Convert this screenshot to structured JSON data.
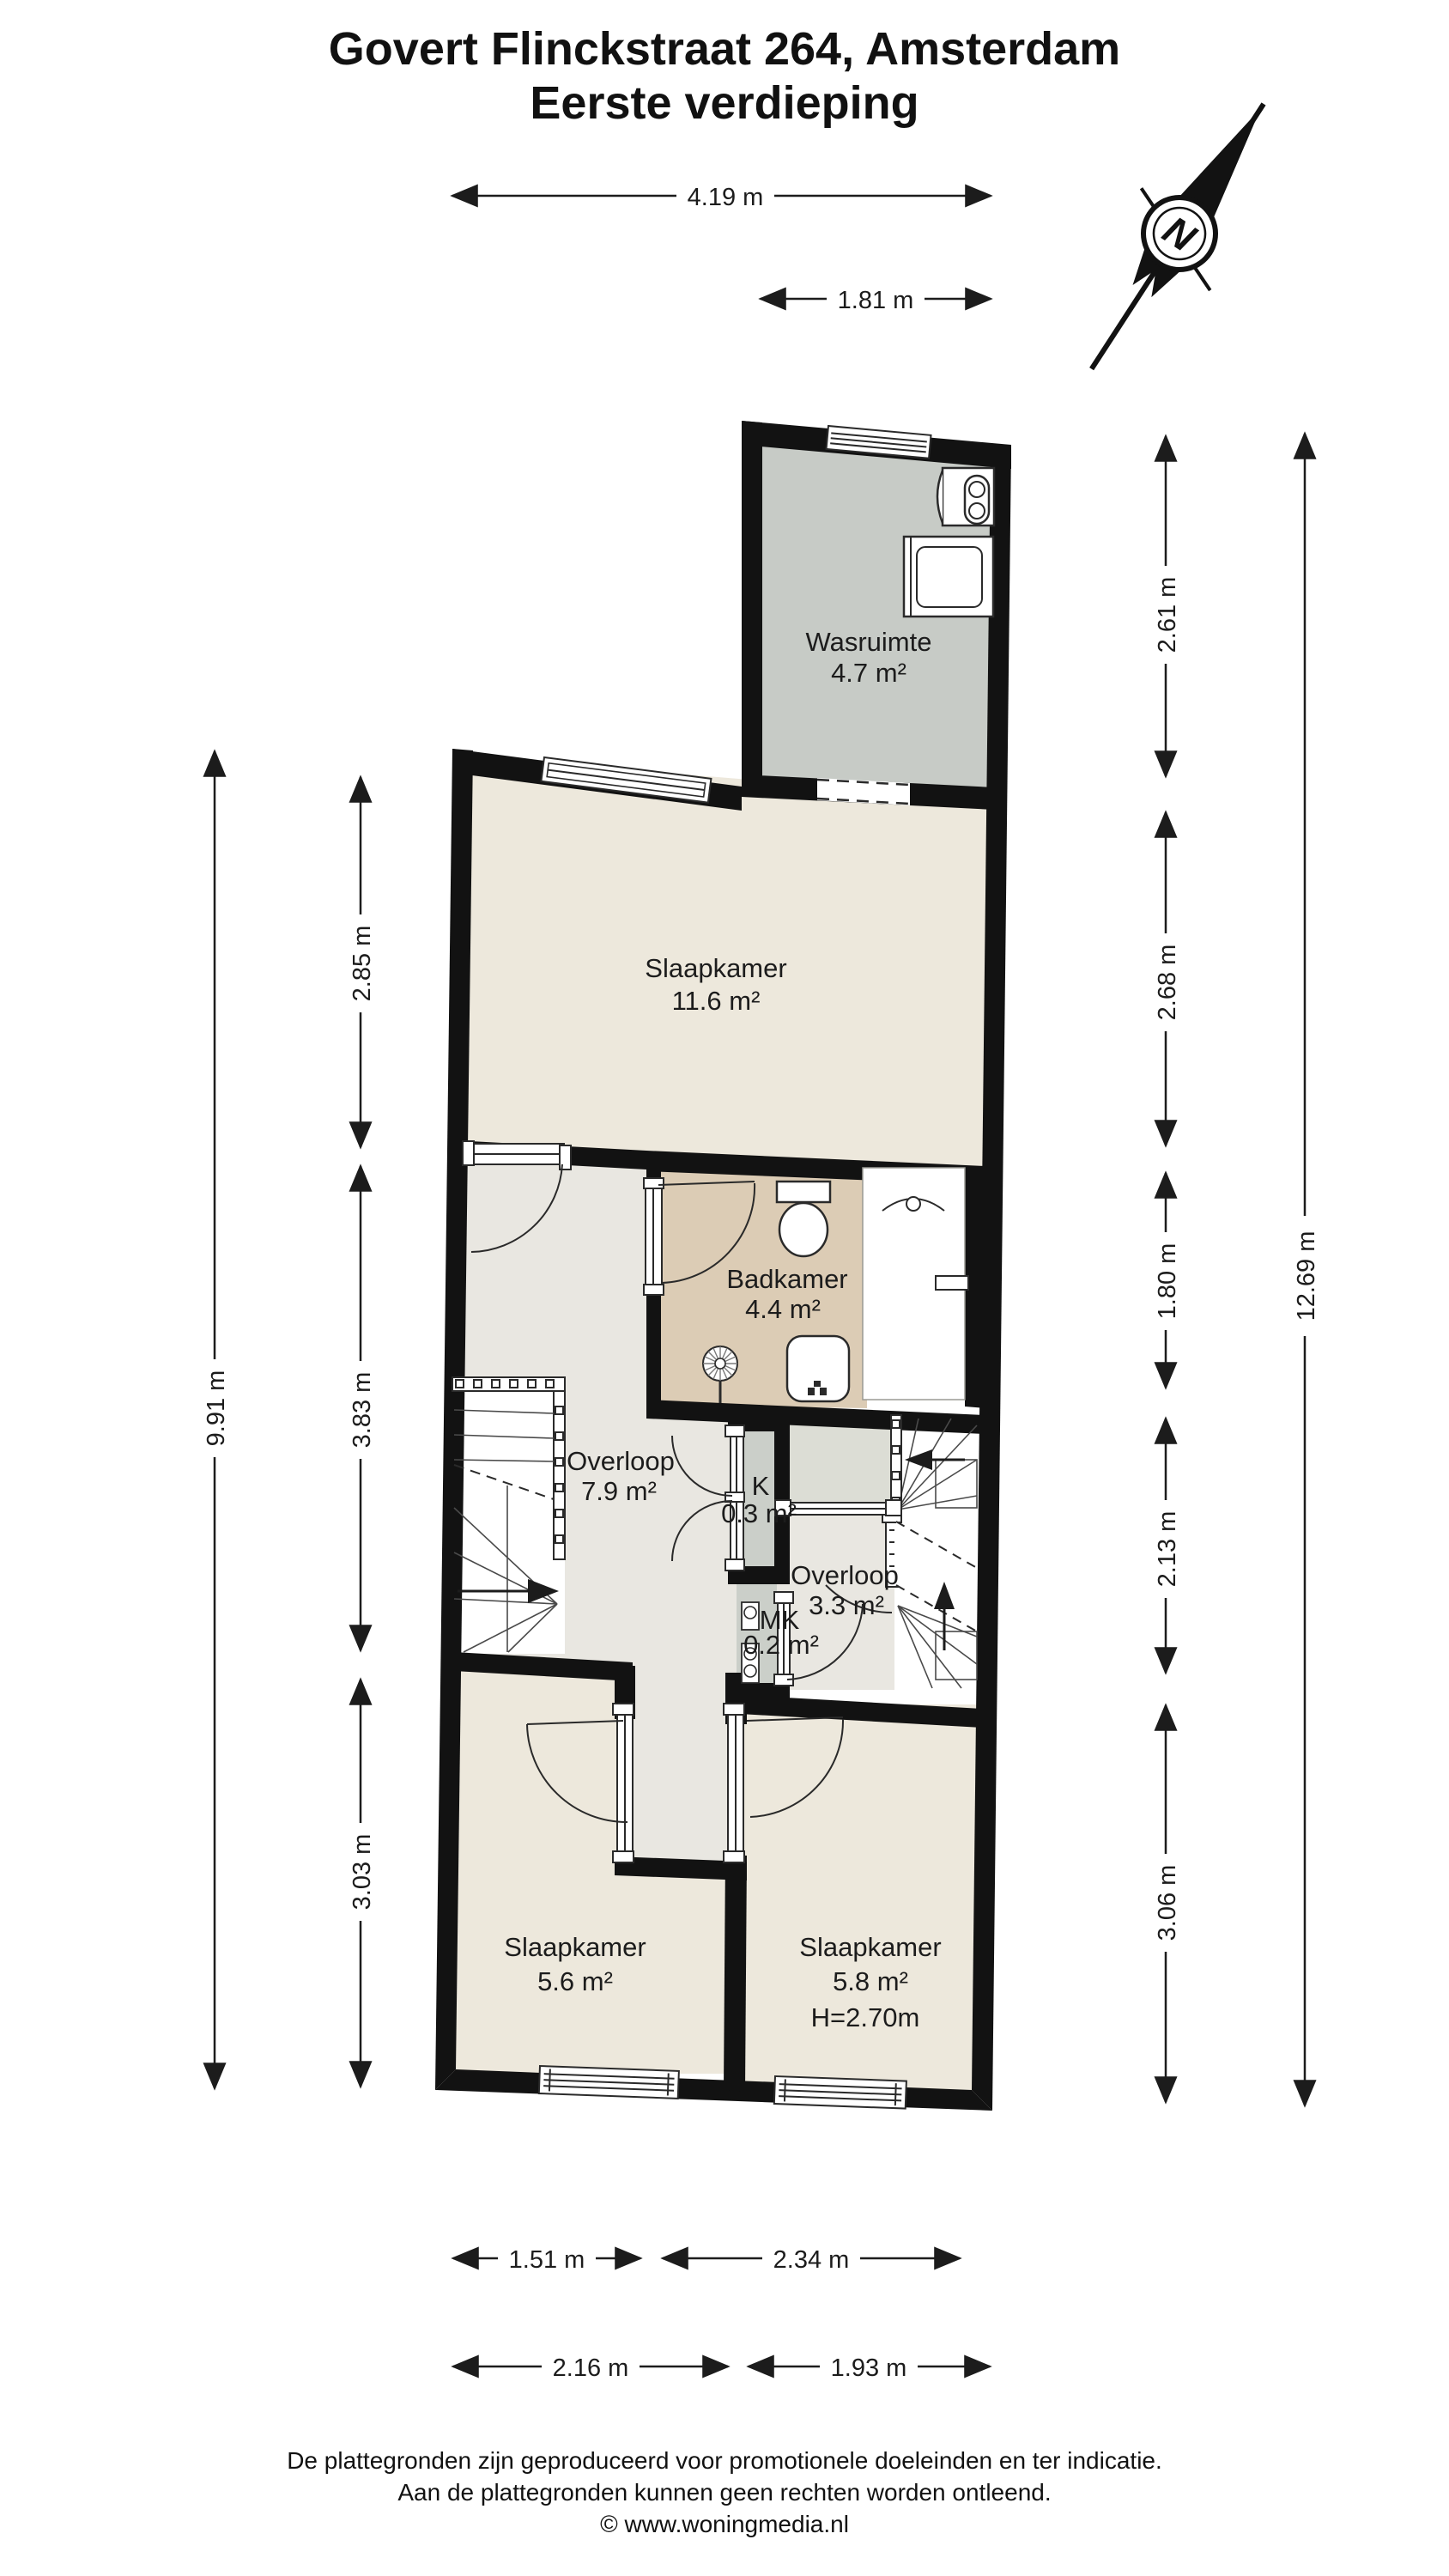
{
  "title": {
    "line1": "Govert Flinckstraat 264, Amsterdam",
    "line2": "Eerste verdieping"
  },
  "compass": {
    "label": "N"
  },
  "rooms": {
    "wasruimte": {
      "name": "Wasruimte",
      "area": "4.7 m²"
    },
    "slaapkamer_boven": {
      "name": "Slaapkamer",
      "area": "11.6 m²"
    },
    "badkamer": {
      "name": "Badkamer",
      "area": "4.4 m²"
    },
    "overloop": {
      "name": "Overloop",
      "area": "7.9 m²"
    },
    "kast": {
      "name": "K",
      "area": "0.3 m²"
    },
    "overloop2": {
      "name": "Overloop",
      "area": "3.3 m²"
    },
    "meterkast": {
      "name": "MK",
      "area": "0.2 m²"
    },
    "slaapkamer_links": {
      "name": "Slaapkamer",
      "area": "5.6 m²"
    },
    "slaapkamer_rechts": {
      "name": "Slaapkamer",
      "area": "5.8 m²",
      "height": "H=2.70m"
    }
  },
  "dimensions": {
    "top": [
      {
        "label": "4.19 m"
      },
      {
        "label": "1.81 m"
      }
    ],
    "left": [
      {
        "label": "2.85 m"
      },
      {
        "label": "3.83 m"
      },
      {
        "label": "3.03 m"
      },
      {
        "label": "9.91 m"
      }
    ],
    "right": [
      {
        "label": "2.61 m"
      },
      {
        "label": "2.68 m"
      },
      {
        "label": "1.80 m"
      },
      {
        "label": "2.13 m"
      },
      {
        "label": "3.06 m"
      },
      {
        "label": "12.69 m"
      }
    ],
    "bottom": [
      {
        "label": "1.51 m"
      },
      {
        "label": "2.34 m"
      },
      {
        "label": "2.16 m"
      },
      {
        "label": "1.93 m"
      }
    ]
  },
  "footer": {
    "line1": "De plattegronden zijn geproduceerd voor promotionele doeleinden en ter indicatie.",
    "line2": "Aan de plattegronden kunnen geen rechten worden ontleend.",
    "line3": "© www.woningmedia.nl"
  },
  "colors": {
    "wall": "#121212",
    "floor_cream": "#EDE8DC",
    "floor_light": "#E9E7E1",
    "floor_gray": "#C7CBC6",
    "floor_tan": "#DCCCB5",
    "floor_closet": "#CBCFC9",
    "floor_stairzone": "#DCDDD5"
  }
}
